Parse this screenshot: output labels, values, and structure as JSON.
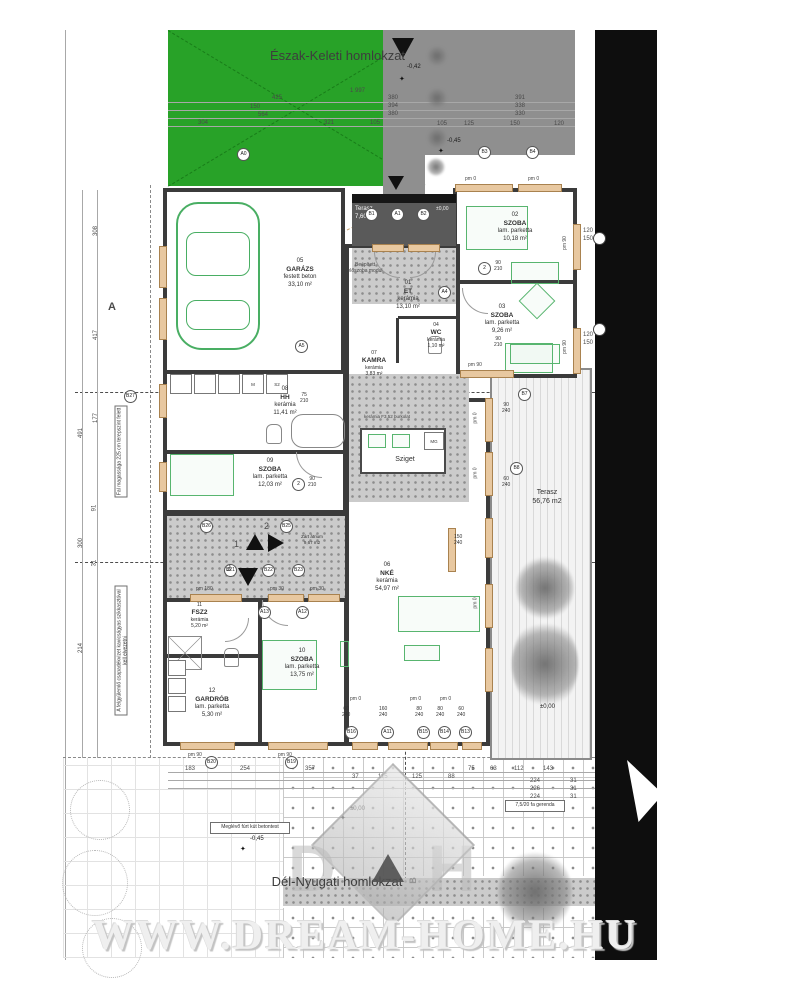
{
  "titles": {
    "top": "Észak-Keleti homlokzat",
    "bottom": "Dél-Nyugati homlokzat",
    "watermark": "WWW.DREAM-HOME.HU"
  },
  "logo": {
    "d": "D",
    "h": "H"
  },
  "rooms": [
    {
      "num": "01",
      "name": "ET",
      "finish": "kerámia",
      "area": "13,10 m²"
    },
    {
      "num": "02",
      "name": "SZOBA",
      "finish": "lam. parketta",
      "area": "10,18 m²"
    },
    {
      "num": "03",
      "name": "SZOBA",
      "finish": "lam. parketta",
      "area": "9,26 m²"
    },
    {
      "num": "04",
      "name": "WC",
      "finish": "kerámia",
      "area": "1,10 m²"
    },
    {
      "num": "05",
      "name": "GARÁZS",
      "finish": "festett beton",
      "area": "33,10 m²"
    },
    {
      "num": "06",
      "name": "NKÉ",
      "finish": "kerámia",
      "area": "54,97 m²"
    },
    {
      "num": "07",
      "name": "KAMRA",
      "finish": "kerámia",
      "area": "3,83 m²"
    },
    {
      "num": "08",
      "name": "HH",
      "finish": "kerámia",
      "area": "11,41 m²"
    },
    {
      "num": "09",
      "name": "SZOBA",
      "finish": "lam. parketta",
      "area": "12,03 m²"
    },
    {
      "num": "10",
      "name": "SZOBA",
      "finish": "lam. parketta",
      "area": "13,75 m²"
    },
    {
      "num": "11",
      "name": "FSZ2",
      "finish": "kerámia",
      "area": "5,20 m²"
    },
    {
      "num": "12",
      "name": "GARDRÓB",
      "finish": "lam. parketta",
      "area": "5,30 m²"
    }
  ],
  "terraces": {
    "entrance": {
      "name": "Terasz",
      "area": "7,60 m2"
    },
    "deck": {
      "name": "Terasz",
      "area": "56,76 m2"
    },
    "atrium": {
      "name": "Zárt átrium",
      "area": "9,67 m2"
    }
  },
  "labels": {
    "sziget": "Sziget",
    "mg": "MG",
    "m": "M",
    "s2": "S2",
    "modul": "Beépített előszoba modul",
    "stone_note": "kerámia F3,52 burkolat",
    "well": "Meglévő fúrt kút betontest",
    "beam": "7,5/20 fa gerenda",
    "wall_note": "Fal magassága 225 cm terepszint felett",
    "rain_note": "A felgyülemlő csapadékvizet kavicságyas szikkasztóval kell elvezetni"
  },
  "levels": {
    "minus042": "-0,42",
    "minus045": "-0,45",
    "zero": "±0,00"
  },
  "markers": {
    "a0": "A0",
    "b1": "B1",
    "a1": "A1",
    "b2": "B2",
    "b3": "B3",
    "b4": "B4",
    "a4": "A4",
    "a5": "A5",
    "b7": "B7",
    "b8": "B8",
    "a11": "A11",
    "a12": "A12",
    "a13": "A13",
    "b13": "B13",
    "b14": "B14",
    "b15": "B15",
    "b16": "B16",
    "b19": "B19",
    "b20": "B20",
    "b21": "B21",
    "b22": "B22",
    "b23": "B23",
    "b25": "B25",
    "b26": "B26",
    "b27": "B27",
    "c2": "2",
    "s1": "1",
    "s2": "2",
    "s3": "3",
    "section_a": "A",
    "section_b": "B"
  },
  "window_labels": {
    "pm0": "pm 0",
    "pm30": "pm 30",
    "pm90": "pm 90",
    "pm180": "pm 180"
  },
  "door_sizes": {
    "d60": "60",
    "d75": "75",
    "d80": "80",
    "d90": "90",
    "d120": "120",
    "d150": "150",
    "d160": "160",
    "d210": "210",
    "d240": "240"
  },
  "dimensions": {
    "top": [
      "1 997",
      "425",
      "150",
      "564",
      "304",
      "321",
      "105"
    ],
    "top_right": [
      "380",
      "394",
      "380",
      "391",
      "338",
      "330",
      "105",
      "125",
      "150",
      "120"
    ],
    "left": [
      "308",
      "417",
      "491",
      "177",
      "91",
      "300",
      "31",
      "214"
    ],
    "bottom": [
      "183",
      "254",
      "357",
      "37",
      "115",
      "125",
      "88",
      "75",
      "63",
      "112",
      "143"
    ],
    "bottom_right": [
      "224",
      "226",
      "224",
      "254",
      "31"
    ]
  },
  "colors": {
    "site_green": "#28a228",
    "driveway_gray": "#8f8f8f",
    "road_black": "#0e0e0e",
    "terrace_dark": "#5a5a5a",
    "wall": "#3b3b3b",
    "window_tan": "#e8c8a0",
    "furniture_green": "#58b56f"
  }
}
